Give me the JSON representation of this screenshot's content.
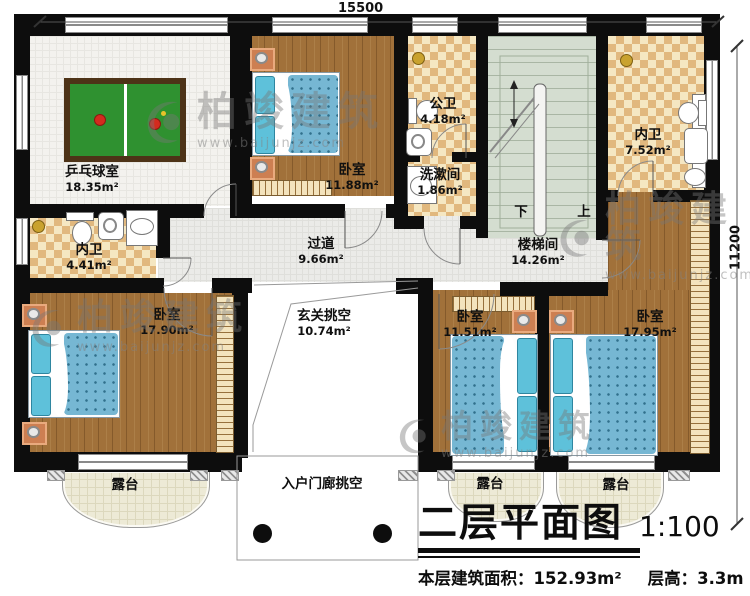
{
  "dimensions": {
    "top": "15500",
    "right": "11200"
  },
  "rooms": {
    "table_tennis": {
      "name": "乒乓球室",
      "area": "18.35m²"
    },
    "bedroom_top": {
      "name": "卧室",
      "area": "11.88m²"
    },
    "public_bath": {
      "name": "公卫",
      "area": "4.18m²"
    },
    "washroom": {
      "name": "洗漱间",
      "area": "1.86m²"
    },
    "ensuite_right": {
      "name": "内卫",
      "area": "7.52m²"
    },
    "ensuite_left": {
      "name": "内卫",
      "area": "4.41m²"
    },
    "hallway": {
      "name": "过道",
      "area": "9.66m²"
    },
    "stairwell": {
      "name": "楼梯间",
      "area": "14.26m²",
      "down_label": "下",
      "up_label": "上"
    },
    "foyer_void": {
      "name": "玄关挑空",
      "area": "10.74m²"
    },
    "bedroom_left": {
      "name": "卧室",
      "area": "17.90m²"
    },
    "bedroom_mid": {
      "name": "卧室",
      "area": "11.51m²"
    },
    "bedroom_right": {
      "name": "卧室",
      "area": "17.95m²"
    },
    "terrace_left": {
      "name": "露台"
    },
    "terrace_mid": {
      "name": "露台"
    },
    "terrace_right": {
      "name": "露台"
    },
    "porch_void": {
      "name": "入户门廊挑空"
    }
  },
  "title": {
    "main": "二层平面图",
    "scale": "1:100",
    "floor_area": "本层建筑面积：152.93m²",
    "floor_height": "层高：3.3m"
  },
  "watermark": {
    "brand": "柏竣建筑",
    "site": "www.baijunjz.com"
  },
  "colors": {
    "wall": "#0d0d0d",
    "wood_floor": "#a1713a",
    "mattress_blue": "#76b7d3",
    "checker_light": "#f5e7c2",
    "checker_dark": "#e1b87e",
    "stairs_green": "#d4ddd0",
    "terrace_cream": "#edead6",
    "table_green": "#2f9130"
  }
}
